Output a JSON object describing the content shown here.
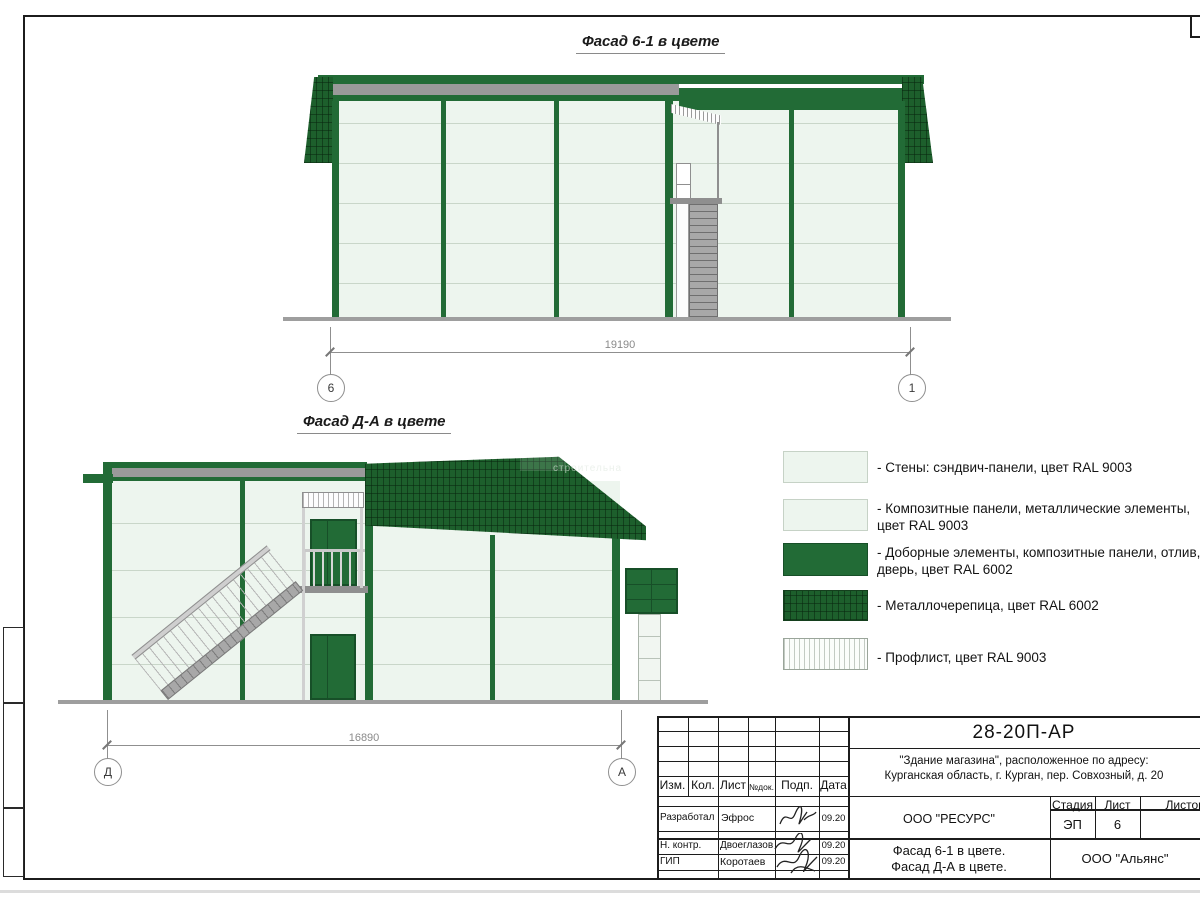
{
  "facade1": {
    "title": "Фасад 6-1 в цвете",
    "dim_value": "19190",
    "axis_left": "6",
    "axis_right": "1"
  },
  "facade2": {
    "title": "Фасад Д-А в цвете",
    "dim_value": "16890",
    "axis_left": "Д",
    "axis_right": "А",
    "watermark": "строительна"
  },
  "legend": {
    "items": [
      {
        "name": "walls-sandwich-panels",
        "label": "- Стены: сэндвич-панели, цвет RAL 9003"
      },
      {
        "name": "composite-panels-metal",
        "label": "- Композитные панели, металлические элементы, цвет RAL 9003"
      },
      {
        "name": "trim-composite-door",
        "label": "- Доборные элементы,  композитные панели, отлив, дверь, цвет RAL 6002"
      },
      {
        "name": "metal-roof-tile",
        "label": "- Металлочерепица, цвет RAL 6002"
      },
      {
        "name": "profiled-sheet",
        "label": "- Профлист, цвет RAL 9003"
      }
    ]
  },
  "title_block": {
    "doc_number": "28-20П-АР",
    "project_line1": "\"Здание магазина\", расположенное по адресу:",
    "project_line2": "Курганская область, г. Курган, пер. Совхозный, д. 20",
    "columns": [
      "Изм.",
      "Кол.",
      "Лист",
      "№док.",
      "Подп.",
      "Дата"
    ],
    "signature_rows": [
      {
        "role": "Разработал",
        "name": "Эфрос",
        "date": "09.20"
      },
      {
        "role": "Н. контр.",
        "name": "Двоеглазов",
        "date": "09.20"
      },
      {
        "role": "ГИП",
        "name": "Коротаев",
        "date": "09.20"
      }
    ],
    "designer_org": "ООО \"РЕСУРС\"",
    "stage_label": "Стадия",
    "sheet_label": "Лист",
    "sheets_label": "Листов",
    "stage_value": "ЭП",
    "sheet_value": "6",
    "sheet_name_line1": "Фасад 6-1 в цвете.",
    "sheet_name_line2": "Фасад Д-А в цвете.",
    "client_org": "ООО \"Альянс\""
  },
  "colors": {
    "accent_green_ral6002": "#226b36",
    "roof_tile_green": "#1d5f2c",
    "panel_ral9003": "#edf5ee",
    "gray_trim": "#9a9a9a"
  }
}
